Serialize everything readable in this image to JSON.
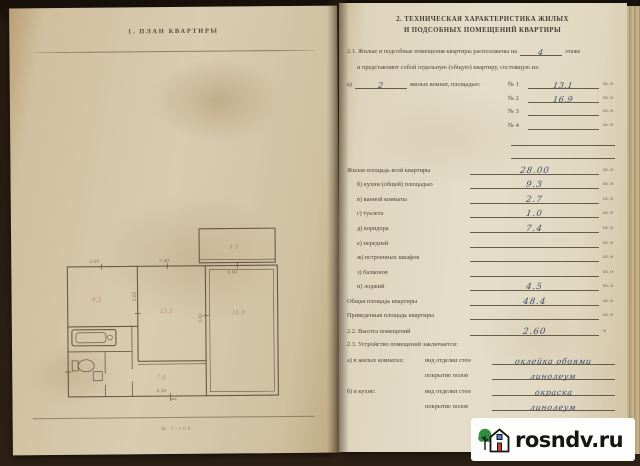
{
  "left_page": {
    "title": "1. ПЛАН КВАРТИРЫ",
    "footer_scale": "М 1:100",
    "plan": {
      "rooms": {
        "kitchen": "9.3",
        "room_mid": "13.1",
        "room_right": "16.9",
        "corridor": "7.4",
        "balcony": "4.5"
      },
      "dims": {
        "top_left": "2.60",
        "top_mid": "3.40",
        "top_right": "4.00",
        "bottom": "4.28",
        "v_mid": "3.42",
        "v_left": "2.62"
      }
    }
  },
  "right_page": {
    "title_line1": "2. ТЕХНИЧЕСКАЯ ХАРАКТЕРИСТИКА ЖИЛЫХ",
    "title_line2": "И ПОДСОБНЫХ ПОМЕЩЕНИЙ КВАРТИРЫ",
    "s21": {
      "line1_pre": "2.1. Жилые и подсобные помещения квартиры расположены на",
      "line1_value": "4",
      "line1_post": "этаже",
      "line2": "и представляют собой отдельную (общую) квартиру, состоящую из:",
      "line3_pre": "а)",
      "line3_value": "2",
      "line3_post": "жилых комнат, площадью:",
      "rooms": [
        {
          "no": "№ 1",
          "value": "13.1",
          "unit": "кв. м"
        },
        {
          "no": "№ 2",
          "value": "16.9",
          "unit": "кв. м"
        },
        {
          "no": "№ 3",
          "value": "",
          "unit": "кв. м"
        },
        {
          "no": "№ 4",
          "value": "",
          "unit": "кв. м"
        }
      ]
    },
    "area_lines": [
      {
        "label": "Жилая площадь всей квартиры",
        "value": "28.00",
        "unit": "кв. м"
      },
      {
        "label": "б) кухни (общей) площадью",
        "value": "9.3",
        "unit": "кв. м"
      },
      {
        "label": "в) ванной комнаты",
        "value": "2.7",
        "unit": "кв. м"
      },
      {
        "label": "г) туалета",
        "value": "1.0",
        "unit": "кв. м"
      },
      {
        "label": "д) коридора",
        "value": "7.4",
        "unit": "кв. м"
      },
      {
        "label": "е) передней",
        "value": "",
        "unit": "кв. м"
      },
      {
        "label": "ж) встроенных шкафов",
        "value": "",
        "unit": "кв. м"
      },
      {
        "label": "з) балконов",
        "value": "",
        "unit": "кв. м"
      },
      {
        "label": "и) лоджий",
        "value": "4.5",
        "unit": "кв. м"
      },
      {
        "label": "Общая площадь квартиры",
        "value": "48.4",
        "unit": "кв. м"
      },
      {
        "label": "Приведенная площадь квартиры",
        "value": "",
        "unit": "кв. м"
      }
    ],
    "s22": {
      "label": "2.2. Высота помещений",
      "value": "2.60",
      "unit": "м"
    },
    "s23": {
      "heading": "2.3. Устройство помещений заключается:",
      "rows": [
        {
          "prefix": "а) в жилых комнатах:",
          "label": "вид отделки стен",
          "value": "оклейка обоями"
        },
        {
          "prefix": "",
          "label": "покрытие полов",
          "value": "линолеум"
        },
        {
          "prefix": "б) в кухне:",
          "label": "вид отделки стен",
          "value": "окраска"
        },
        {
          "prefix": "",
          "label": "покрытие полов",
          "value": "линолеум"
        }
      ]
    }
  },
  "watermark": {
    "text": "rosndv.ru"
  }
}
